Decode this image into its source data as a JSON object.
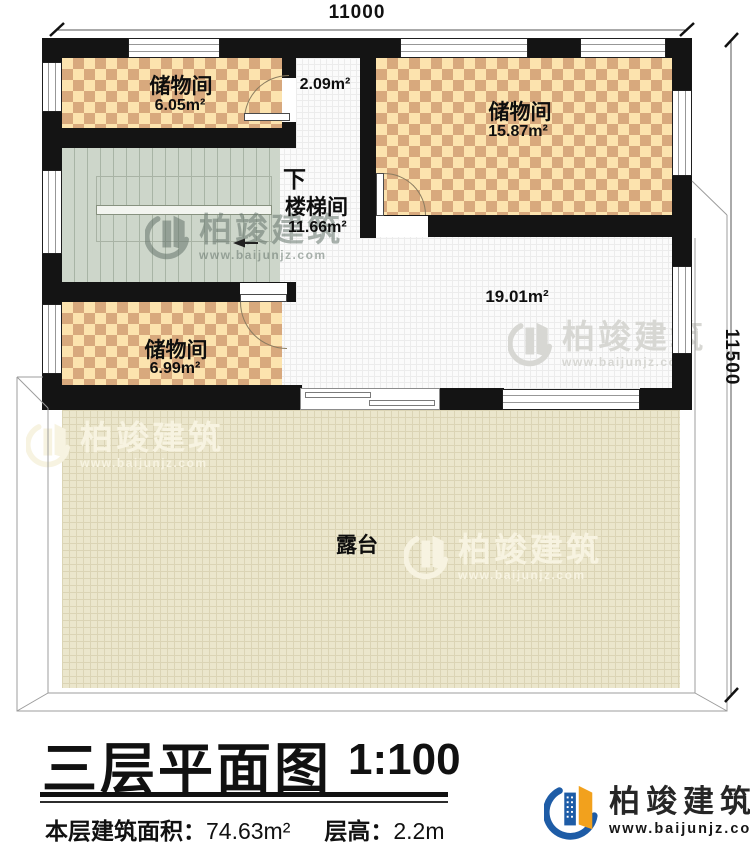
{
  "dimensions": {
    "top": "11000",
    "right": "11500"
  },
  "rooms": {
    "storage_a": {
      "name": "储物间",
      "area": "6.05m²"
    },
    "hallway": {
      "area": "2.09m²"
    },
    "storage_b": {
      "name": "储物间",
      "area": "15.87m²"
    },
    "stair": {
      "name": "楼梯间",
      "area": "11.66m²",
      "down": "下"
    },
    "storage_c": {
      "name": "储物间",
      "area": "6.99m²"
    },
    "hall": {
      "area": "19.01m²"
    },
    "terrace": {
      "name": "露台"
    }
  },
  "titleblock": {
    "title": "三层平面图",
    "scale": "1:100",
    "area_label": "本层建筑面积：",
    "area_value": "74.63m²",
    "height_label": "层高：",
    "height_value": "2.2m"
  },
  "brand": {
    "name": "柏竣建筑",
    "url": "www.baijunjz.com"
  },
  "watermark": {
    "name": "柏竣建筑",
    "url": "www.baijunjz.com"
  },
  "colors": {
    "wall": "#141414",
    "checker_light": "#fce3ae",
    "checker_dark": "#d8a97d",
    "stair_fill": "#cdd6ca",
    "terrace_fill": "#ebe6cc",
    "logo_blue": "#1e5ca6",
    "logo_orange": "#f2a11d"
  }
}
